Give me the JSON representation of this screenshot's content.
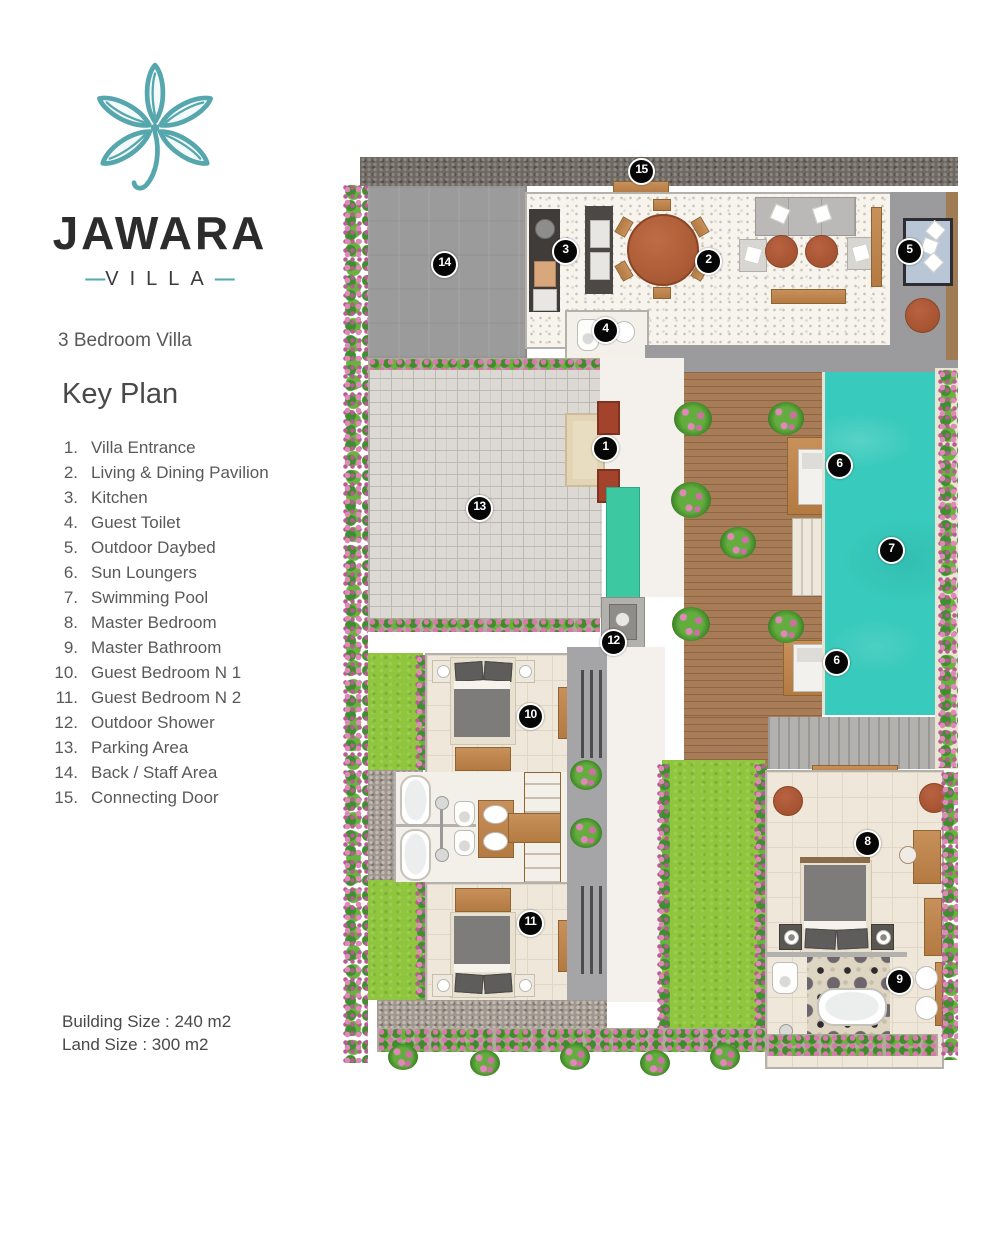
{
  "brand": {
    "name": "JAWARA",
    "type": "VILLA",
    "dash": "—"
  },
  "subtitle": "3 Bedroom Villa",
  "legend": {
    "title": "Key Plan",
    "items": [
      {
        "num": "1.",
        "label": "Villa Entrance"
      },
      {
        "num": "2.",
        "label": "Living & Dining Pavilion"
      },
      {
        "num": "3.",
        "label": "Kitchen"
      },
      {
        "num": "4.",
        "label": "Guest Toilet"
      },
      {
        "num": "5.",
        "label": "Outdoor Daybed"
      },
      {
        "num": "6.",
        "label": "Sun Loungers"
      },
      {
        "num": "7.",
        "label": "Swimming Pool"
      },
      {
        "num": "8.",
        "label": "Master Bedroom"
      },
      {
        "num": "9.",
        "label": "Master Bathroom"
      },
      {
        "num": "10.",
        "label": "Guest Bedroom N 1"
      },
      {
        "num": "11.",
        "label": "Guest Bedroom N 2"
      },
      {
        "num": "12.",
        "label": "Outdoor Shower"
      },
      {
        "num": "13.",
        "label": "Parking Area"
      },
      {
        "num": "14.",
        "label": "Back / Staff Area"
      },
      {
        "num": "15.",
        "label": "Connecting Door"
      }
    ]
  },
  "sizes": {
    "building": "Building Size : 240 m2",
    "land": "Land Size : 300 m2"
  },
  "plan": {
    "markers": [
      {
        "n": "1",
        "x": 604,
        "y": 447
      },
      {
        "n": "2",
        "x": 707,
        "y": 260
      },
      {
        "n": "3",
        "x": 564,
        "y": 250
      },
      {
        "n": "4",
        "x": 604,
        "y": 329
      },
      {
        "n": "5",
        "x": 908,
        "y": 250
      },
      {
        "n": "6",
        "x": 838,
        "y": 464
      },
      {
        "n": "6",
        "x": 835,
        "y": 661
      },
      {
        "n": "7",
        "x": 890,
        "y": 549
      },
      {
        "n": "8",
        "x": 866,
        "y": 842
      },
      {
        "n": "9",
        "x": 898,
        "y": 980
      },
      {
        "n": "10",
        "x": 529,
        "y": 715
      },
      {
        "n": "11",
        "x": 529,
        "y": 922
      },
      {
        "n": "12",
        "x": 612,
        "y": 641
      },
      {
        "n": "13",
        "x": 478,
        "y": 507
      },
      {
        "n": "14",
        "x": 443,
        "y": 263
      },
      {
        "n": "15",
        "x": 640,
        "y": 170
      }
    ]
  },
  "colors": {
    "accent_teal": "#56a7ad",
    "pool": "#38cabc",
    "lawn": "#8fc63e",
    "deck_wood": "#a87c57",
    "furniture_wood": "#c0854c",
    "entrance_red": "#a4432c",
    "marker_bg": "#060606",
    "text_dark": "#2d2c2c",
    "text_gray": "#5a5959"
  }
}
